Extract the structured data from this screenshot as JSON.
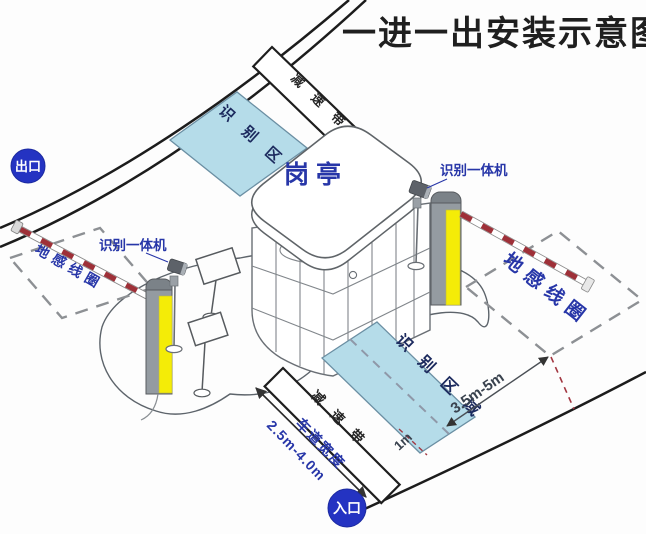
{
  "title": "一进一出安装示意图",
  "badges": {
    "exit": "出口",
    "entrance": "入口"
  },
  "booth": {
    "label": "岗亭"
  },
  "zones": {
    "recognition_area": "识别区域",
    "ground_loop": "地感线圈",
    "speed_bump": "减速带"
  },
  "devices": {
    "recognition_machine": "识别一体机"
  },
  "dimensions": {
    "lane_width_label": "车道宽度",
    "lane_width_value": "2.5m-4.0m",
    "loop_setback": "3.5m-5m",
    "stop_line_offset": "1m"
  },
  "colors": {
    "recognition_zone_fill": "#b5dce9",
    "badge_blue": "#2433c2",
    "label_blue": "#2736a8",
    "barrier_stripe_red": "#9e3038",
    "machine_yellow": "#f4ec07",
    "machine_gray": "#949ba1"
  }
}
